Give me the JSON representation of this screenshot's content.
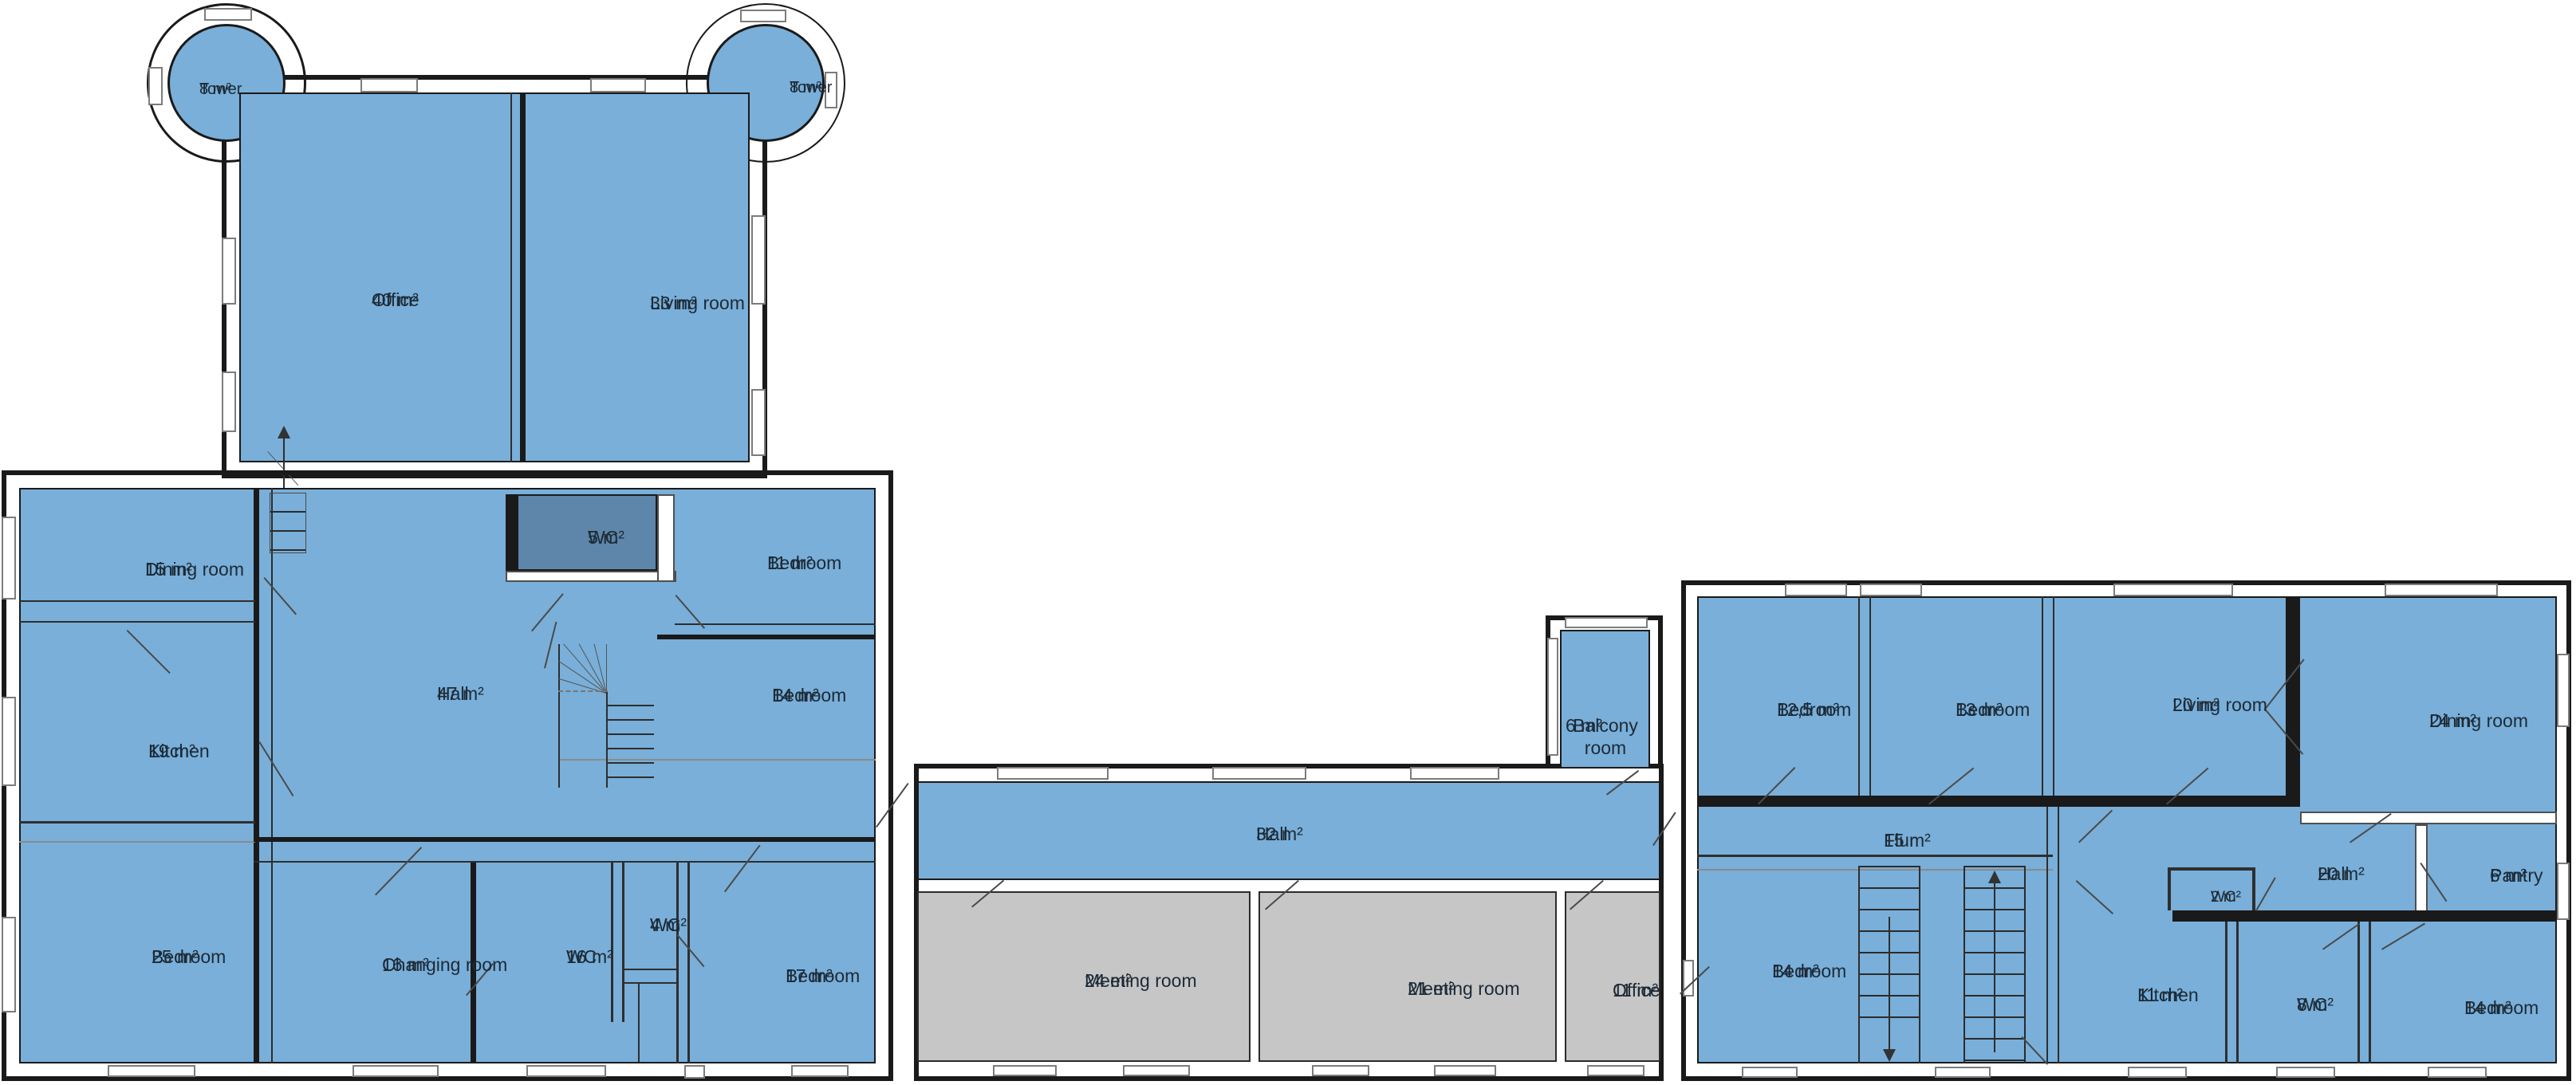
{
  "document": {
    "type": "floor-plan",
    "language_note": "room labels in English with German 'Flur', areas in square meters"
  },
  "colors": {
    "background": "#ffffff",
    "room_fill": "#79AFD9",
    "wc_fill": "#5E86AA",
    "meeting_fill": "#C6C6C6",
    "wall": "#1A1A1A",
    "window_border": "#7C7C7C",
    "label_text": "#1D2A36"
  },
  "rooms": [
    {
      "id": "tower-west",
      "area": "8 m²",
      "name": "Tower",
      "building": "north-wing"
    },
    {
      "id": "tower-east",
      "area": "8 m²",
      "name": "Tower",
      "building": "north-wing"
    },
    {
      "id": "office-40",
      "area": "40 m²",
      "name": "Office",
      "building": "north-wing"
    },
    {
      "id": "living-33",
      "area": "33 m²",
      "name": "Living room",
      "building": "north-wing"
    },
    {
      "id": "dining-15",
      "area": "15 m²",
      "name": "Dining room",
      "building": "west-wing"
    },
    {
      "id": "kitchen-19",
      "area": "19 m²",
      "name": "Kitchen",
      "building": "west-wing"
    },
    {
      "id": "bedroom-25",
      "area": "25 m²",
      "name": "Bedroom",
      "building": "west-wing"
    },
    {
      "id": "hall-47",
      "area": "47 m²",
      "name": "Hall",
      "building": "west-wing"
    },
    {
      "id": "wc-5",
      "area": "5 m²",
      "name": "WC",
      "building": "west-wing"
    },
    {
      "id": "bedroom-11",
      "area": "11 m²",
      "name": "Bedroom",
      "building": "west-wing"
    },
    {
      "id": "bedroom-14-west",
      "area": "14 m²",
      "name": "Bedroom",
      "building": "west-wing"
    },
    {
      "id": "changing-16",
      "area": "16 m²",
      "name": "Changing room",
      "building": "west-wing"
    },
    {
      "id": "wc-16",
      "area": "16 m²",
      "name": "WC",
      "building": "west-wing"
    },
    {
      "id": "wc-4",
      "area": "4 m²",
      "name": "WC",
      "building": "west-wing"
    },
    {
      "id": "bedroom-17",
      "area": "17 m²",
      "name": "Bedroom",
      "building": "west-wing"
    },
    {
      "id": "hall-32",
      "area": "32 m²",
      "name": "Hall",
      "building": "center-wing"
    },
    {
      "id": "meeting-24",
      "area": "24 m²",
      "name": "Meeting room",
      "building": "center-wing"
    },
    {
      "id": "meeting-21",
      "area": "21 m²",
      "name": "Meeting room",
      "building": "center-wing"
    },
    {
      "id": "office-11",
      "area": "11 m²",
      "name": "Office",
      "building": "center-wing"
    },
    {
      "id": "balcony-6",
      "area": "6 m²",
      "name": "Balcony room",
      "building": "center-wing"
    },
    {
      "id": "bedroom-12-5",
      "area": "12,5 m²",
      "name": "Bedroom",
      "building": "east-wing"
    },
    {
      "id": "bedroom-13",
      "area": "13 m²",
      "name": "Bedroom",
      "building": "east-wing"
    },
    {
      "id": "living-20",
      "area": "20 m²",
      "name": "Living room",
      "building": "east-wing"
    },
    {
      "id": "dining-24",
      "area": "24 m²",
      "name": "Dining room",
      "building": "east-wing"
    },
    {
      "id": "flur-15",
      "area": "15 m²",
      "name": "Flur",
      "building": "east-wing"
    },
    {
      "id": "wc-2",
      "area": "2 m²",
      "name": "WC",
      "building": "east-wing"
    },
    {
      "id": "hall-20",
      "area": "20 m²",
      "name": "Hall",
      "building": "east-wing"
    },
    {
      "id": "pantry-6",
      "area": "6 m²",
      "name": "Pantry",
      "building": "east-wing"
    },
    {
      "id": "bedroom-14-south-west",
      "area": "14 m²",
      "name": "Bedroom",
      "building": "east-wing"
    },
    {
      "id": "kitchen-11",
      "area": "11 m²",
      "name": "Kitchen",
      "building": "east-wing"
    },
    {
      "id": "wc-8",
      "area": "8 m²",
      "name": "WC",
      "building": "east-wing"
    },
    {
      "id": "bedroom-14-south-east",
      "area": "14 m²",
      "name": "Bedroom",
      "building": "east-wing"
    }
  ]
}
